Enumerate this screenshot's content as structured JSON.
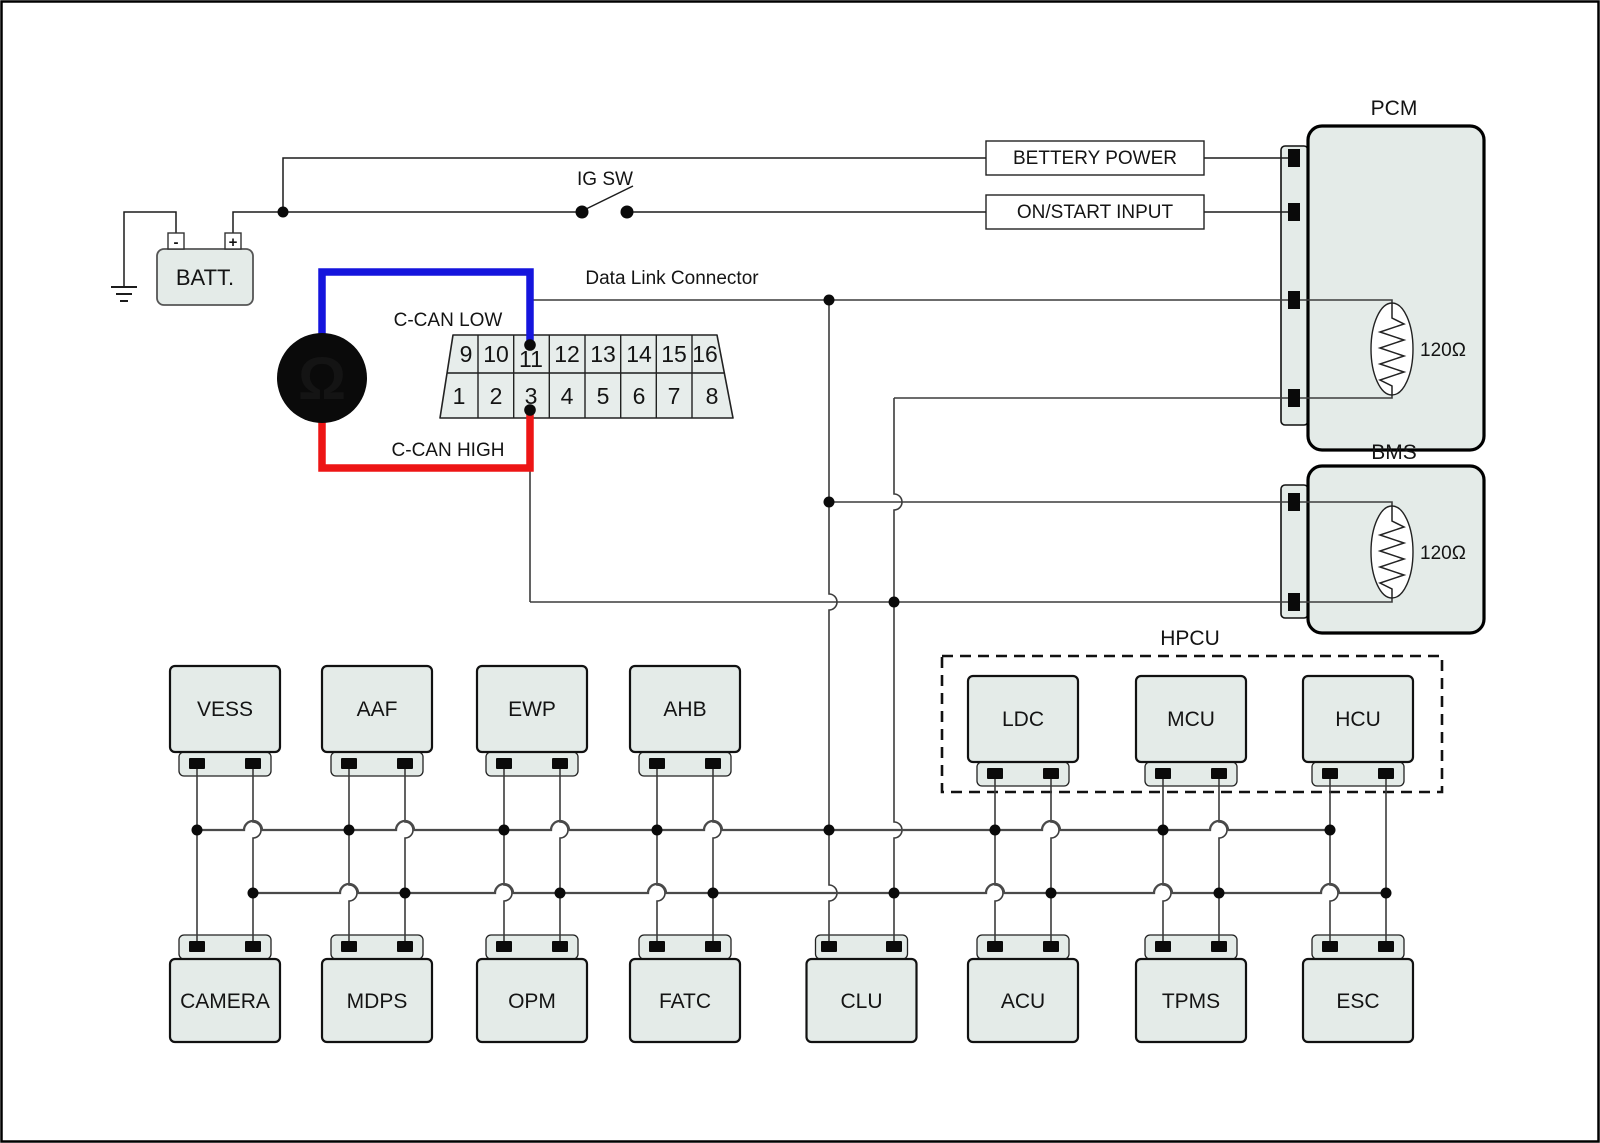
{
  "colors": {
    "module_fill": "#e4ebe8",
    "wire": "#3c3c3c",
    "bus": "#4a4a4a",
    "can_low_blue": "#1515dd",
    "can_high_red": "#ed1515",
    "pin_black": "#0a0a0a"
  },
  "battery": {
    "label": "BATT.",
    "neg_terminal": "-",
    "pos_terminal": "+"
  },
  "ignition_switch": {
    "label": "IG SW"
  },
  "power_inputs": {
    "battery_power": "BETTERY POWER",
    "on_start": "ON/START INPUT"
  },
  "dlc": {
    "title": "Data Link Connector",
    "can_low_label": "C-CAN LOW",
    "can_high_label": "C-CAN HIGH",
    "ohm_meter": "Ω",
    "pins_top": [
      "9",
      "10",
      "11",
      "12",
      "13",
      "14",
      "15",
      "16"
    ],
    "pins_bottom": [
      "1",
      "2",
      "3",
      "4",
      "5",
      "6",
      "7",
      "8"
    ]
  },
  "pcm": {
    "title": "PCM",
    "resistor_label": "120Ω"
  },
  "bms": {
    "title": "BMS",
    "resistor_label": "120Ω"
  },
  "hpcu": {
    "title": "HPCU",
    "modules": [
      {
        "label": "LDC"
      },
      {
        "label": "MCU"
      },
      {
        "label": "HCU"
      }
    ]
  },
  "top_modules": [
    {
      "label": "VESS"
    },
    {
      "label": "AAF"
    },
    {
      "label": "EWP"
    },
    {
      "label": "AHB"
    }
  ],
  "bottom_modules": [
    {
      "label": "CAMERA"
    },
    {
      "label": "MDPS"
    },
    {
      "label": "OPM"
    },
    {
      "label": "FATC"
    },
    {
      "label": "CLU"
    },
    {
      "label": "ACU"
    },
    {
      "label": "TPMS"
    },
    {
      "label": "ESC"
    }
  ]
}
